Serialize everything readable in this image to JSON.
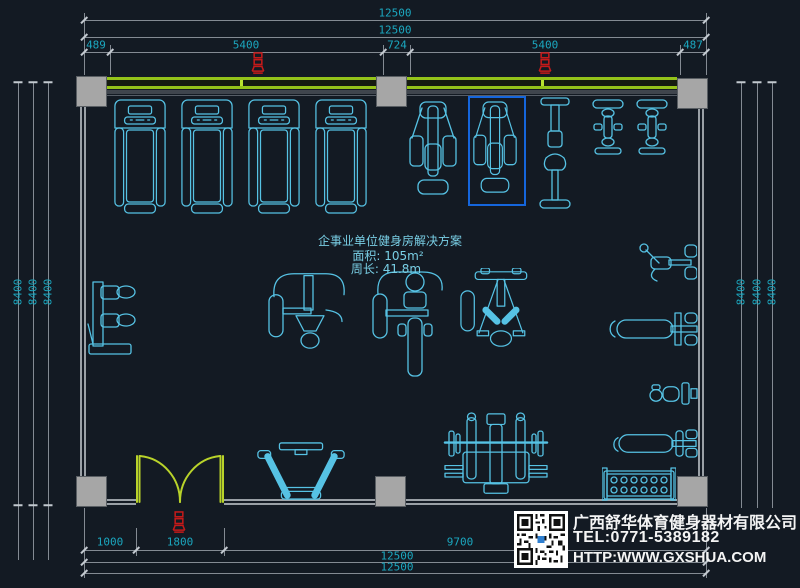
{
  "annotation": {
    "title": "企事业单位健身房解决方案",
    "area": "面积: 105m²",
    "perimeter": "周长: 41.8m"
  },
  "dimensions": {
    "top": {
      "overall_1": "12500",
      "overall_2": "12500",
      "segments": [
        "489",
        "5400",
        "724",
        "5400",
        "487"
      ]
    },
    "bottom": {
      "segments": [
        "1000",
        "1800",
        "9700"
      ],
      "overall_1": "12500",
      "overall_2": "12500"
    },
    "left": [
      "8400",
      "8400",
      "8400"
    ],
    "right": [
      "8400",
      "8400",
      "8400"
    ]
  },
  "title_block": {
    "company": "广西舒华体育健身器材有限公司",
    "tel": "TEL:0771-5389182",
    "website": "HTTP:WWW.GXSHUA.COM"
  },
  "colors": {
    "background": "#131a23",
    "equipment_line": "#56c2e4",
    "dimension_text": "#1ba7bf",
    "dimension_line": "#848b93",
    "wall_gray": "#9aa0a6",
    "column_fill": "#a6a6a6",
    "window_green": "#94c31a",
    "door_green": "#b9d32a",
    "selection_blue": "#1566dd",
    "tag_red": "#c41a1a",
    "title_text": "#f4f4f4"
  },
  "equipment": {
    "items": [
      "treadmill",
      "treadmill",
      "treadmill",
      "treadmill",
      "elliptical",
      "elliptical-selected",
      "upright-bike",
      "spin-bike",
      "spin-bike",
      "wall-dual-station",
      "shoulder-press-machine",
      "lat-pulldown-machine",
      "pec-fly-machine",
      "curl-station",
      "press-bench",
      "seated-unit",
      "flat-bench",
      "dumbbell-rack",
      "hack-squat-machine",
      "bench-press-rack",
      "double-door"
    ]
  }
}
